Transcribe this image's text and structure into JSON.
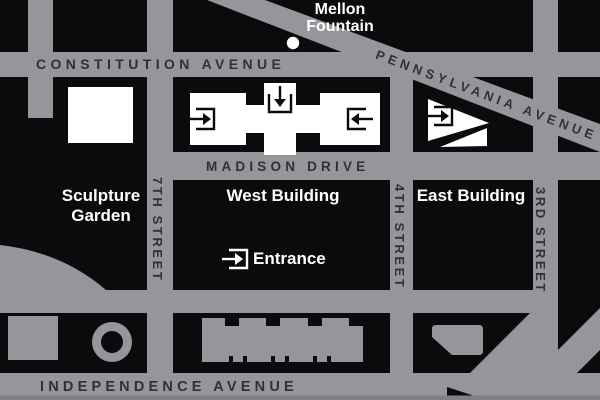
{
  "map": {
    "streets": {
      "constitution": "CONSTITUTION AVENUE",
      "pennsylvania": "PENNSYLVANIA AVENUE",
      "madison": "MADISON DRIVE",
      "independence": "INDEPENDENCE AVENUE",
      "seventh": "7TH STREET",
      "fourth": "4TH STREET",
      "third": "3RD STREET"
    },
    "places": {
      "mellon_fountain": "Mellon Fountain",
      "sculpture_garden": "Sculpture Garden",
      "west_building": "West Building",
      "east_building": "East Building"
    },
    "legend": {
      "entrance": "Entrance"
    },
    "icons": {
      "entrance_icon": "arrow-into-open-bracket",
      "fountain_dot": "white-circle"
    },
    "colors": {
      "background": "#0b0b0d",
      "street_gray": "#95969a",
      "street_label_dark": "#303136",
      "place_label_white": "#ffffff",
      "building_white": "#ffffff",
      "bottom_edge_gray": "#7f8084"
    }
  }
}
